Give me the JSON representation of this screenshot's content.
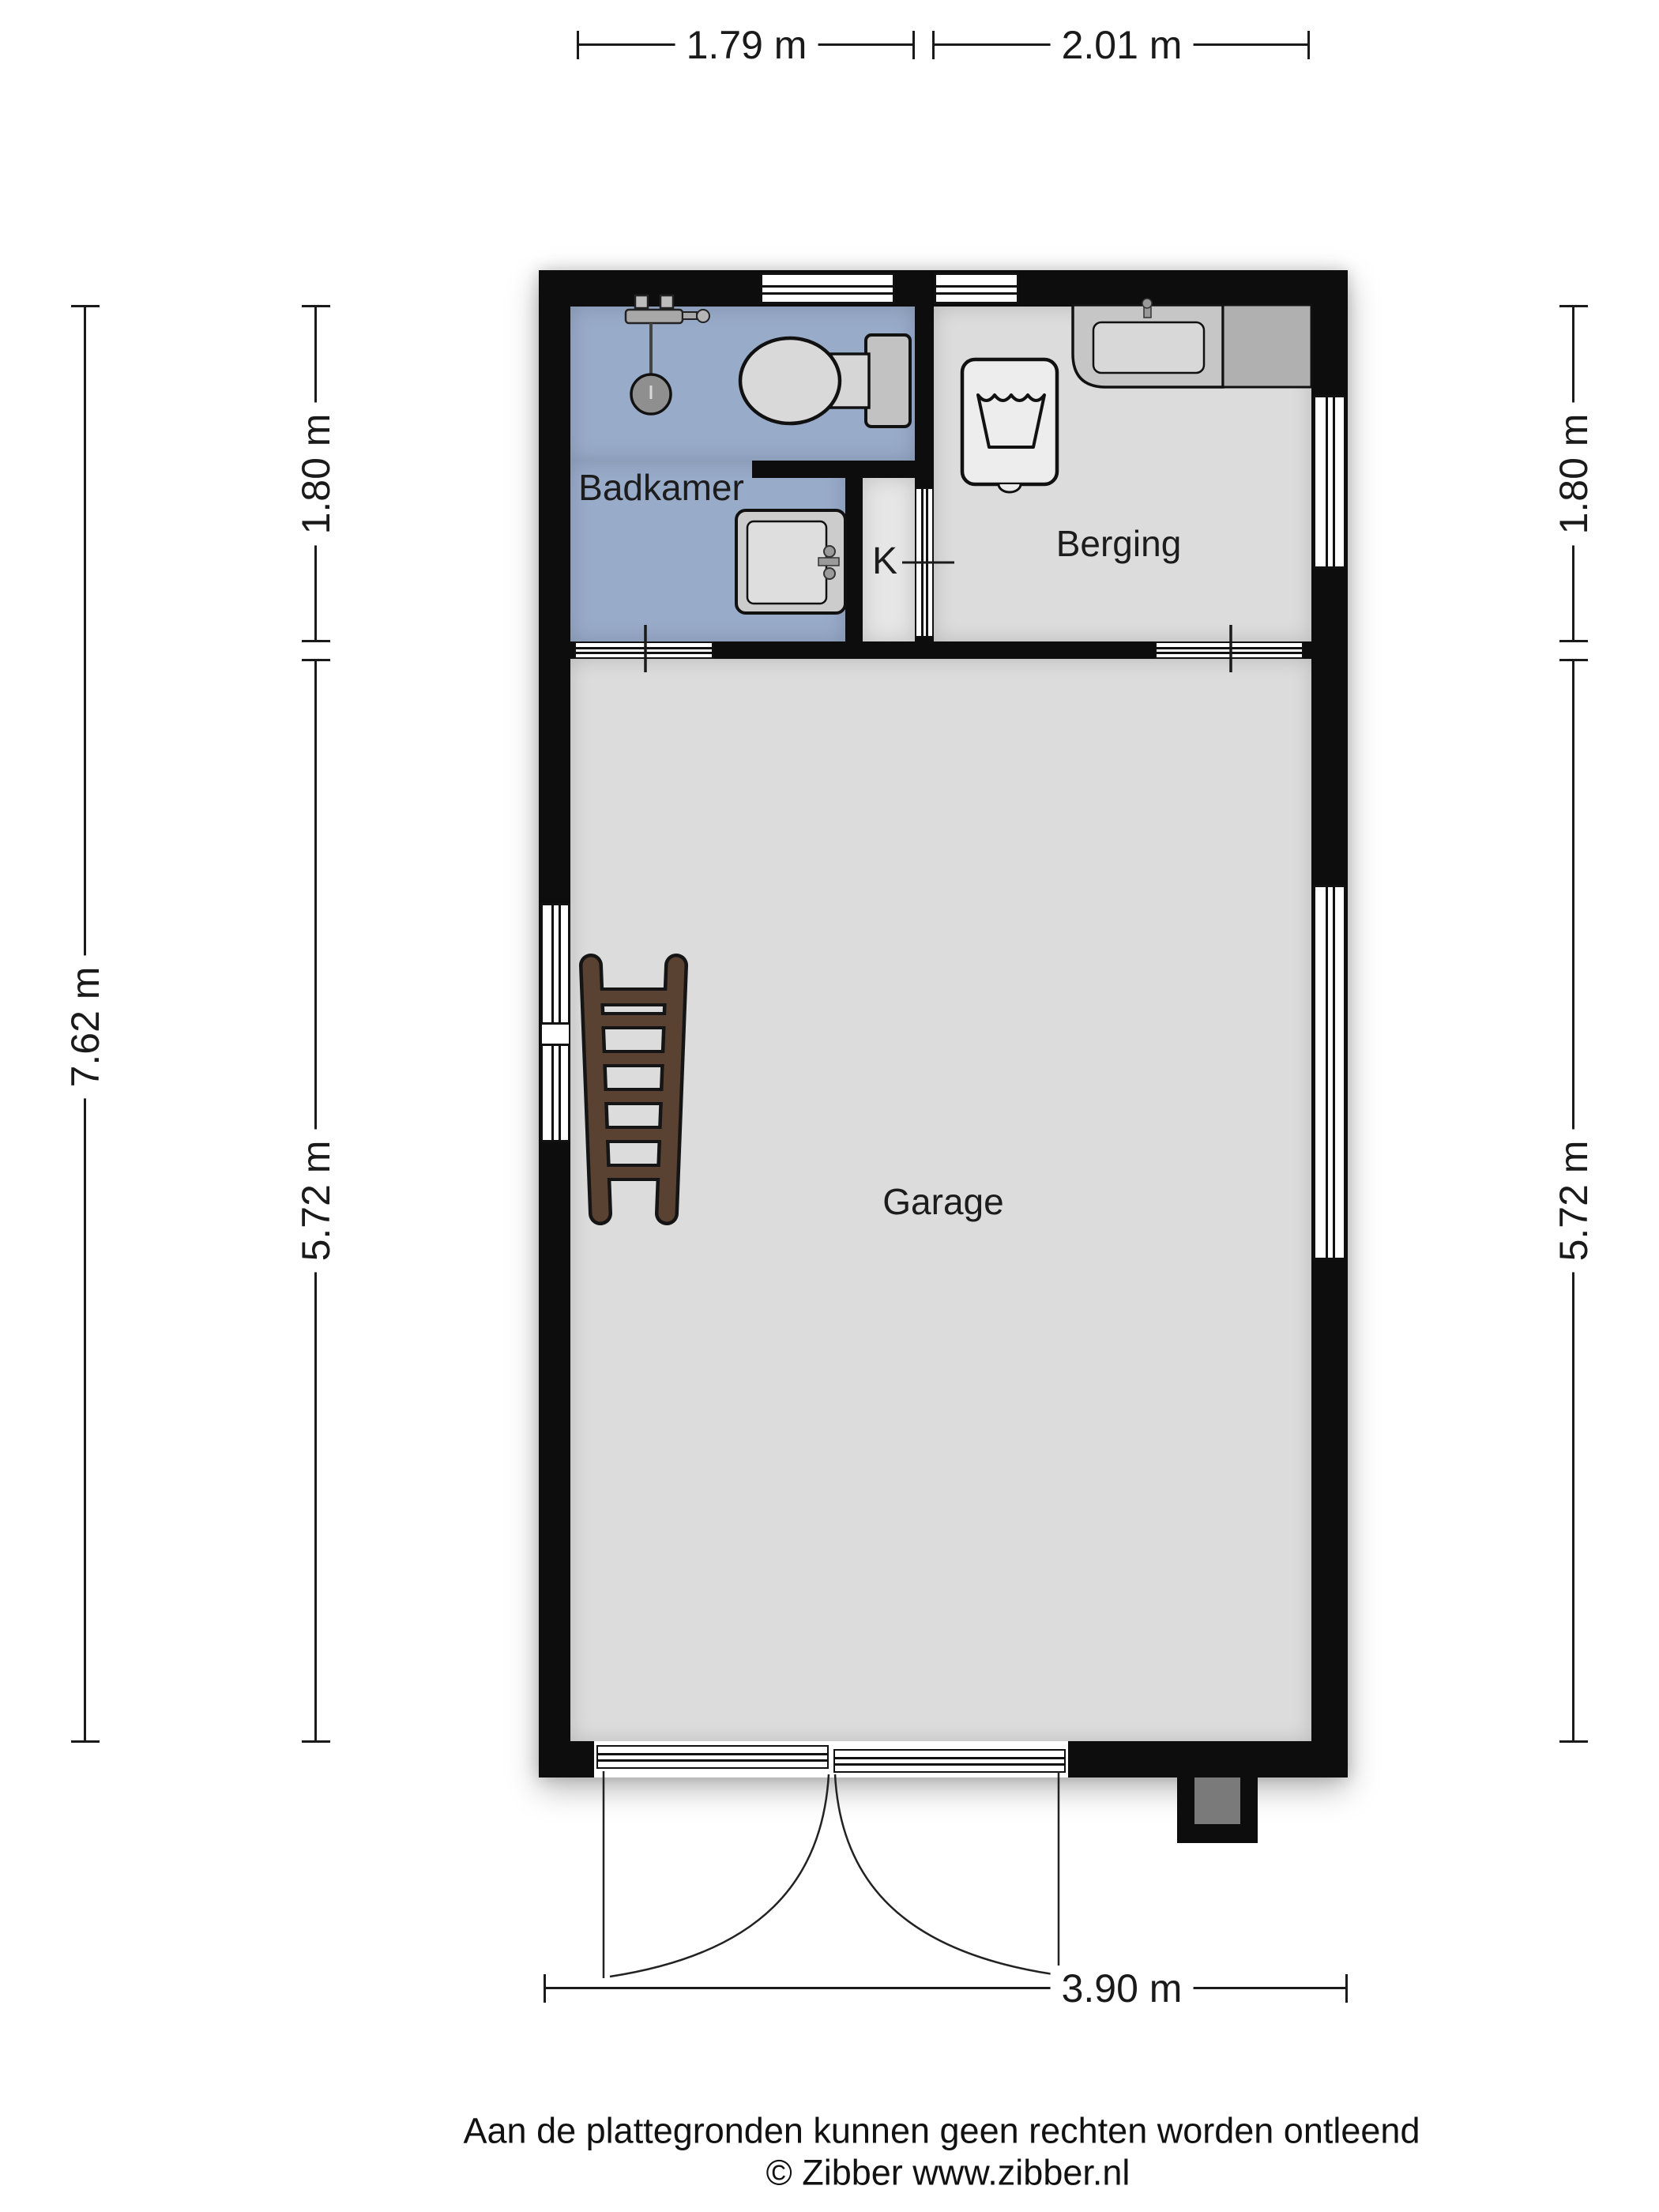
{
  "dimensions": {
    "top": [
      {
        "label": "1.79 m"
      },
      {
        "label": "2.01 m"
      }
    ],
    "left": {
      "overall": "7.62 m",
      "segments": [
        {
          "label": "1.80 m"
        },
        {
          "label": "5.72 m"
        }
      ]
    },
    "right": {
      "segments": [
        {
          "label": "1.80 m"
        },
        {
          "label": "5.72 m"
        }
      ]
    },
    "bottom": {
      "label": "3.90 m"
    }
  },
  "rooms": {
    "badkamer": {
      "label": "Badkamer"
    },
    "kast": {
      "label": "K"
    },
    "berging": {
      "label": "Berging"
    },
    "garage": {
      "label": "Garage"
    }
  },
  "furniture": [
    "shower-mixer",
    "shower-head",
    "toilet",
    "washbasin",
    "washing-machine",
    "laundry-sink",
    "counter",
    "ladder"
  ],
  "footer": {
    "disclaimer": "Aan de plattegronden kunnen geen rechten worden ontleend",
    "credit": "© Zibber www.zibber.nl"
  },
  "colors": {
    "bathroom_floor": "#98abc9",
    "room_floor": "#dcdcdc",
    "wall": "#0d0d0d",
    "ladder_wood": "#5a4233"
  }
}
